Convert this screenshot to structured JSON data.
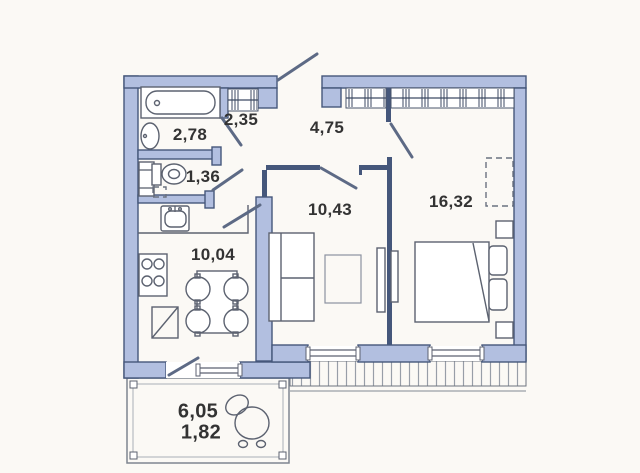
{
  "title": "Apartment floor plan",
  "colors": {
    "wall-fill": "#b2bfe0",
    "wall-stroke": "#45577b",
    "furniture-line": "#5c6270",
    "hatch-line": "#989ea8",
    "label-text": "#333333",
    "background": "#fbf9f5"
  },
  "labels": {
    "bathroom": "2,78",
    "closet": "2,35",
    "hallway": "4,75",
    "wc": "1,36",
    "living": "10,43",
    "bedroom": "16,32",
    "kitchen": "10,04",
    "balcony_full": "6,05",
    "balcony_reduced": "1,82"
  },
  "icons": [
    "bathtub-icon",
    "washbasin-icon",
    "toilet-icon",
    "washer-icon",
    "hanger-rail-icon",
    "kitchen-sink-icon",
    "stove-icon",
    "dining-table-icon",
    "chair-icon",
    "sofa-icon",
    "coffee-table-icon",
    "bed-icon",
    "pillow-icon",
    "nightstand-icon",
    "wardrobe-dashed-icon",
    "armchair-icon",
    "door-leaf-icon",
    "window-icon"
  ]
}
